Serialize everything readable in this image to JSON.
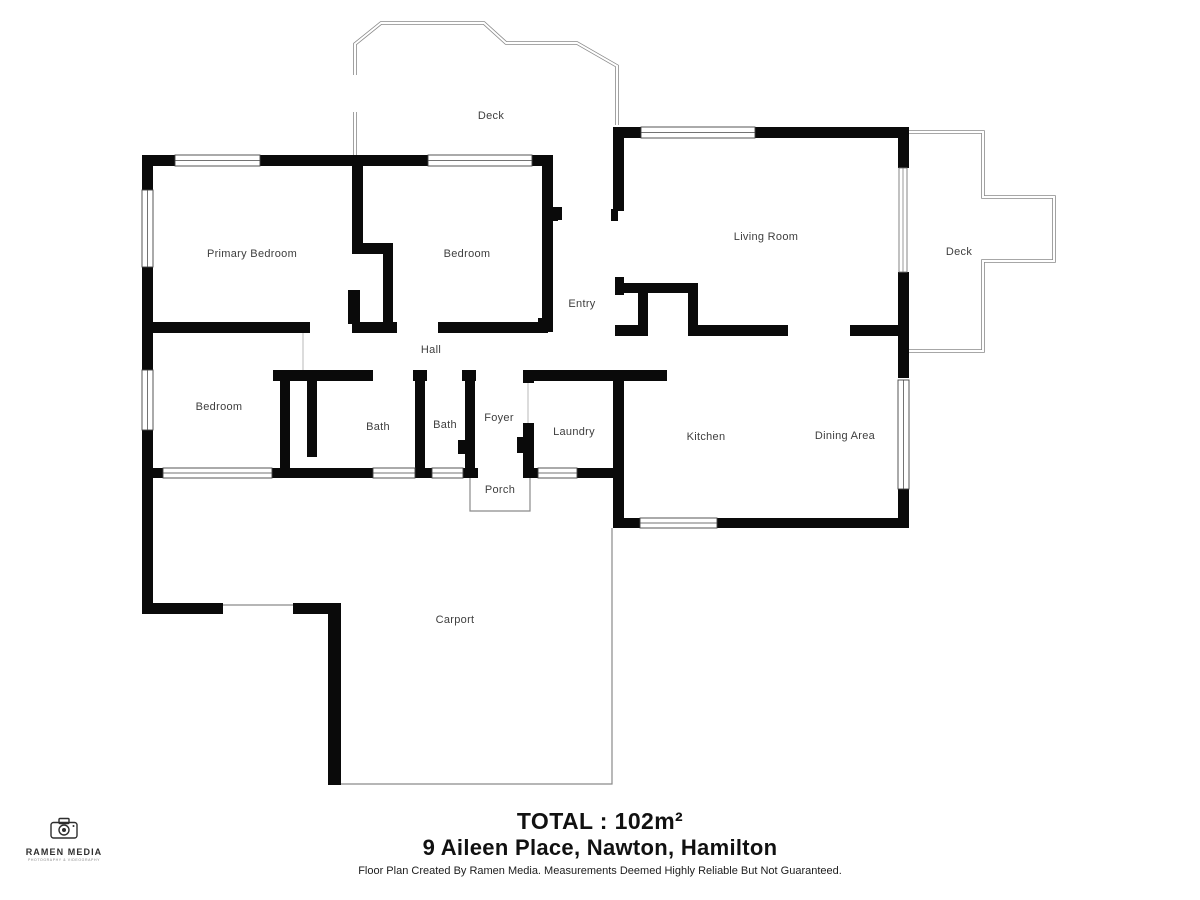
{
  "plan": {
    "rooms": [
      {
        "name": "deck-top",
        "label": "Deck",
        "x": 491,
        "y": 116
      },
      {
        "name": "primary-bedroom",
        "label": "Primary Bedroom",
        "x": 252,
        "y": 254
      },
      {
        "name": "bedroom-top",
        "label": "Bedroom",
        "x": 467,
        "y": 254
      },
      {
        "name": "entry",
        "label": "Entry",
        "x": 582,
        "y": 304
      },
      {
        "name": "living-room",
        "label": "Living Room",
        "x": 766,
        "y": 237
      },
      {
        "name": "deck-right",
        "label": "Deck",
        "x": 959,
        "y": 252
      },
      {
        "name": "hall",
        "label": "Hall",
        "x": 431,
        "y": 350
      },
      {
        "name": "bedroom-left",
        "label": "Bedroom",
        "x": 219,
        "y": 407
      },
      {
        "name": "bath-1",
        "label": "Bath",
        "x": 378,
        "y": 427
      },
      {
        "name": "bath-2",
        "label": "Bath",
        "x": 445,
        "y": 425
      },
      {
        "name": "foyer",
        "label": "Foyer",
        "x": 499,
        "y": 418
      },
      {
        "name": "laundry",
        "label": "Laundry",
        "x": 574,
        "y": 432
      },
      {
        "name": "kitchen",
        "label": "Kitchen",
        "x": 706,
        "y": 437
      },
      {
        "name": "dining-area",
        "label": "Dining Area",
        "x": 845,
        "y": 436
      },
      {
        "name": "porch",
        "label": "Porch",
        "x": 500,
        "y": 490
      },
      {
        "name": "carport",
        "label": "Carport",
        "x": 455,
        "y": 620
      }
    ]
  },
  "footer": {
    "total": "TOTAL : 102m²",
    "address": "9 Aileen Place, Nawton, Hamilton",
    "disclaimer": "Floor Plan Created By Ramen Media. Measurements Deemed Highly Reliable But Not Guaranteed."
  },
  "logo": {
    "name": "RAMEN MEDIA",
    "tagline": "PHOTOGRAPHY & VIDEOGRAPHY"
  },
  "colors": {
    "wall": "#0a0a0a",
    "label": "#3e3e3e",
    "outline": "#8a8a8a",
    "text": "#111111"
  }
}
